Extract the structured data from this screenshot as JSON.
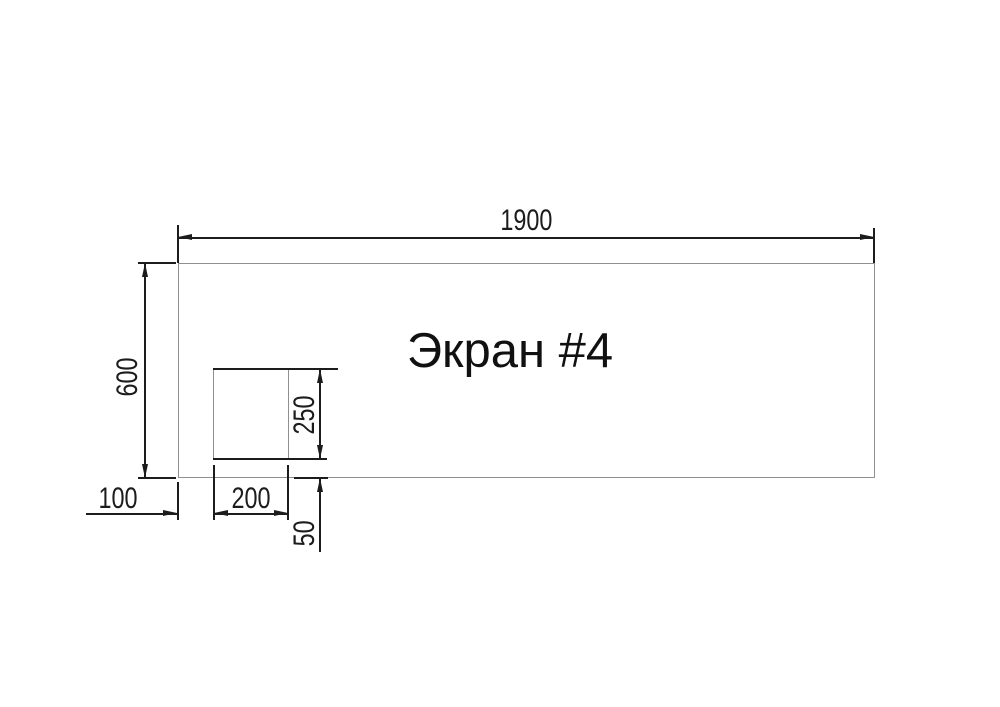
{
  "drawing": {
    "title": "Экран #4",
    "dim_width": "1900",
    "dim_height": "600",
    "dim_cutout_offset_left": "100",
    "dim_cutout_width": "200",
    "dim_cutout_height": "250",
    "dim_cutout_offset_bottom": "50",
    "colors": {
      "outline_gray": "#8f8f8f",
      "dimension_black": "#1c1c1c",
      "background": "#ffffff"
    }
  }
}
